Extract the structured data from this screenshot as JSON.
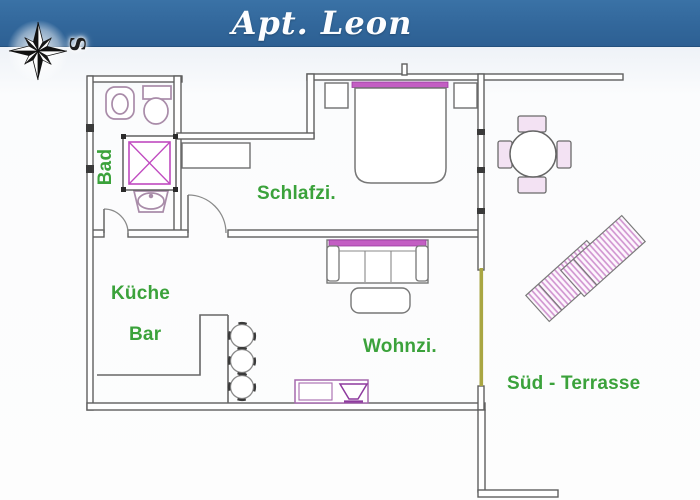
{
  "title": "Apt. Leon",
  "compass": {
    "label": "S"
  },
  "rooms": {
    "bad": "Bad",
    "schlafzimmer": "Schlafzi.",
    "kueche": "Küche",
    "bar": "Bar",
    "wohnzimmer": "Wohnzi.",
    "terrasse": "Süd - Terrasse"
  },
  "colors": {
    "banner_blue": "#32679b",
    "title_white": "#fcfdff",
    "label_green": "#3ba23b",
    "wall_gray": "#5f5f5f",
    "fixture_pink": "#a98ca9",
    "accent_magenta": "#c35ec3",
    "furniture_purple": "#a569ad",
    "lounger_stripe_pink": "#cf92cf",
    "terrace_door_olive": "#a9a642"
  }
}
